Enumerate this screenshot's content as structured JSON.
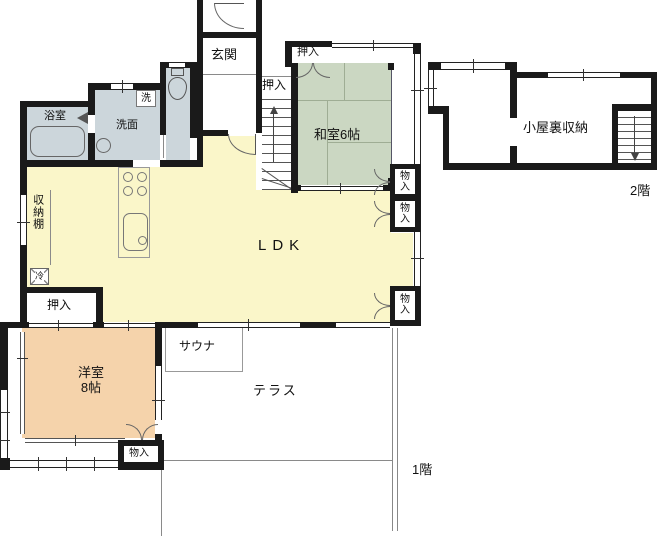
{
  "colors": {
    "wall": "#1a1a1a",
    "ldk-fill": "#faf6c9",
    "washitsu-fill": "#cbd7c2",
    "youshitsu-fill": "#f5d3ab",
    "wet-fill": "#ccd6db"
  },
  "labels": {
    "genkan": "玄関",
    "oshiire": "押入",
    "washitsu": "和室6帖",
    "monoiri": "物入",
    "ldk": "LDK",
    "youshitsu_name": "洋室",
    "youshitsu_size": "8帖",
    "sauna": "サウナ",
    "terrace": "テラス",
    "bath": "浴室",
    "washroom": "洗面",
    "laundry": "洗",
    "shelf": "収納棚",
    "fridge": "冷",
    "attic": "小屋裏収納",
    "floor2": "2階",
    "floor1": "1階"
  }
}
